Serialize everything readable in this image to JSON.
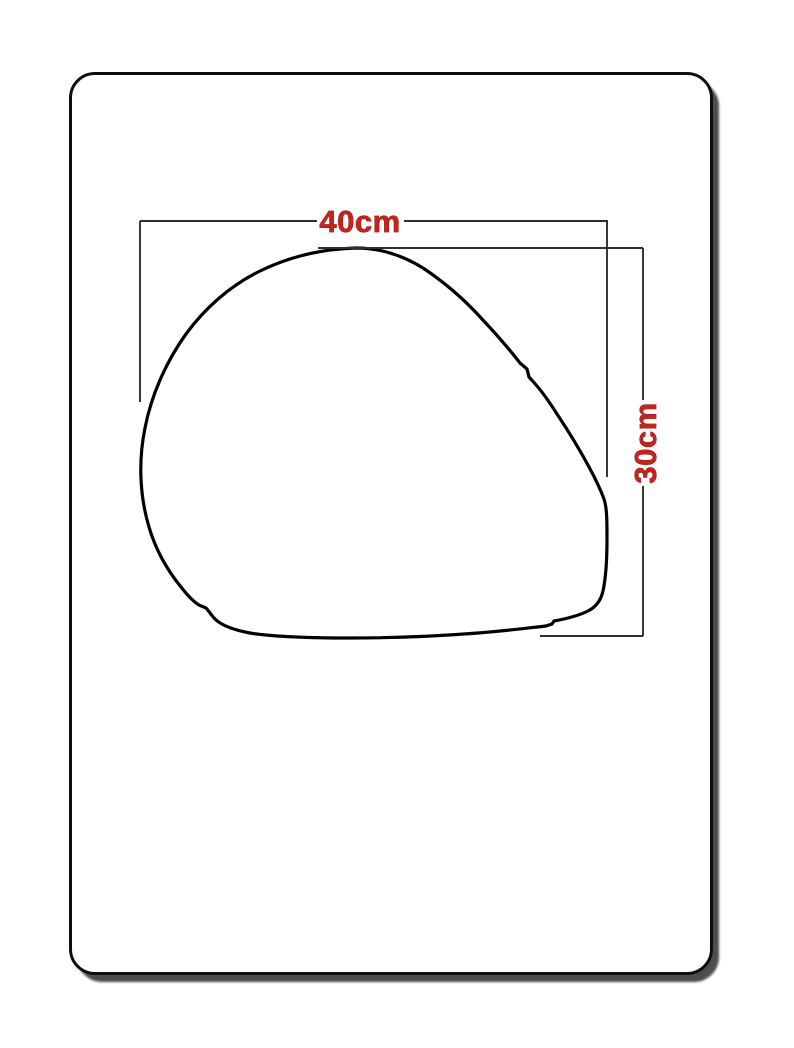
{
  "page": {
    "background": "#ffffff"
  },
  "card": {
    "background": "#ffffff",
    "border_color": "#0e0e0e",
    "shadow_color": "#343434",
    "outline_shape": "helmet-side-view"
  },
  "diagram": {
    "width_label": "40cm",
    "height_label": "30cm",
    "width_cm": 40,
    "height_cm": 30,
    "label_color": "#c3241e",
    "line_color": "#2e2e2e",
    "outline_color": "#000000"
  }
}
